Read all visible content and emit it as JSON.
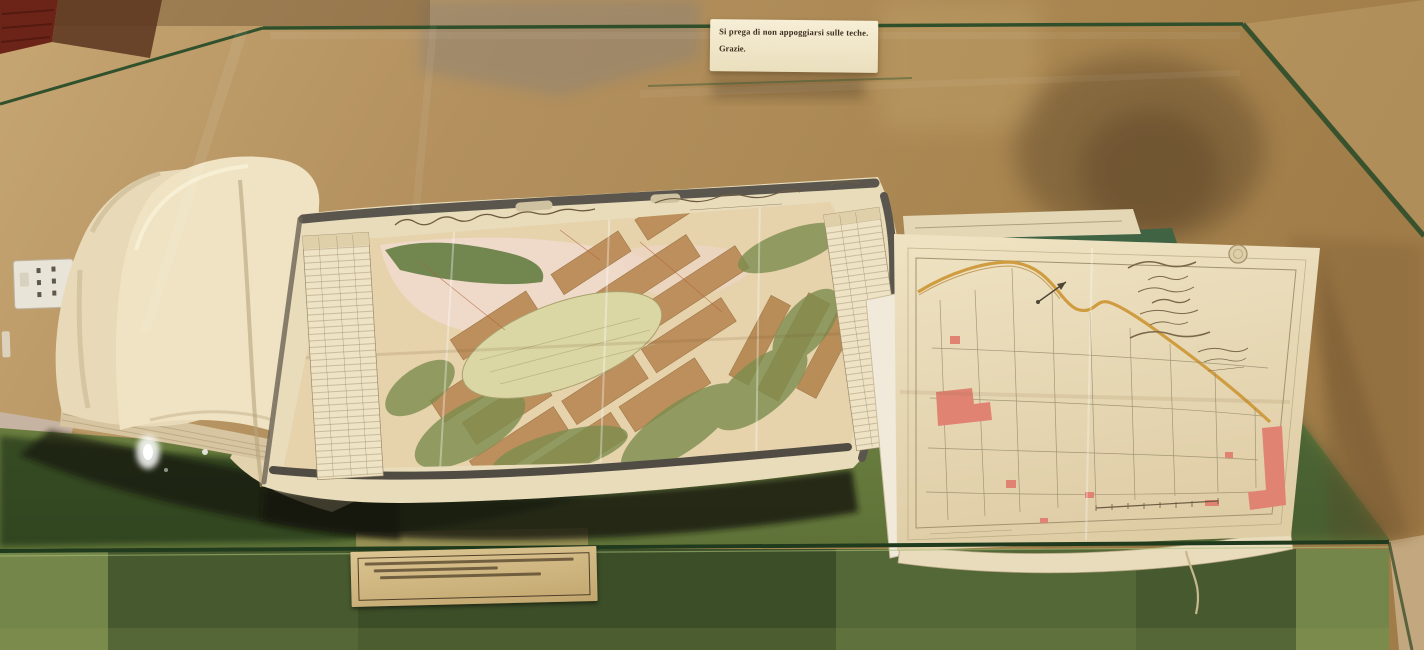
{
  "sign": {
    "line1": "Si prega di non appoggiarsi sulle teche.",
    "line2": "Grazie."
  },
  "caption": {
    "note": "typewritten exhibit caption, three lines, too small to be legible",
    "line_count": 3
  },
  "handwriting": {
    "left_map_title": "handwritten cursive title across top of fold-out plan (illegible)",
    "right_map_title": "handwritten cursive cartouche with round stamp (illegible)"
  },
  "objects": {
    "book": "open bound volume with curled blank pages",
    "left_map": "hand-coloured fold-out town plan with grey border and index tables",
    "right_map": "pale cadastral plan with ochre road, pink buildings, compass and scale bar"
  },
  "colors": {
    "wall": "#b3905e",
    "door": "#6d2418",
    "glass_edge": "#2f4f2a",
    "base_green": "#75864a",
    "base_dark": "#1c2f17",
    "paper": "#e9dcba",
    "map_block_tan": "#bb8c58",
    "map_green": "#7c8d4e",
    "map_pink": "#f0d9cb",
    "building_red": "#e08373",
    "road_ochre": "#d09c40",
    "floor": "#c7b3a1"
  }
}
